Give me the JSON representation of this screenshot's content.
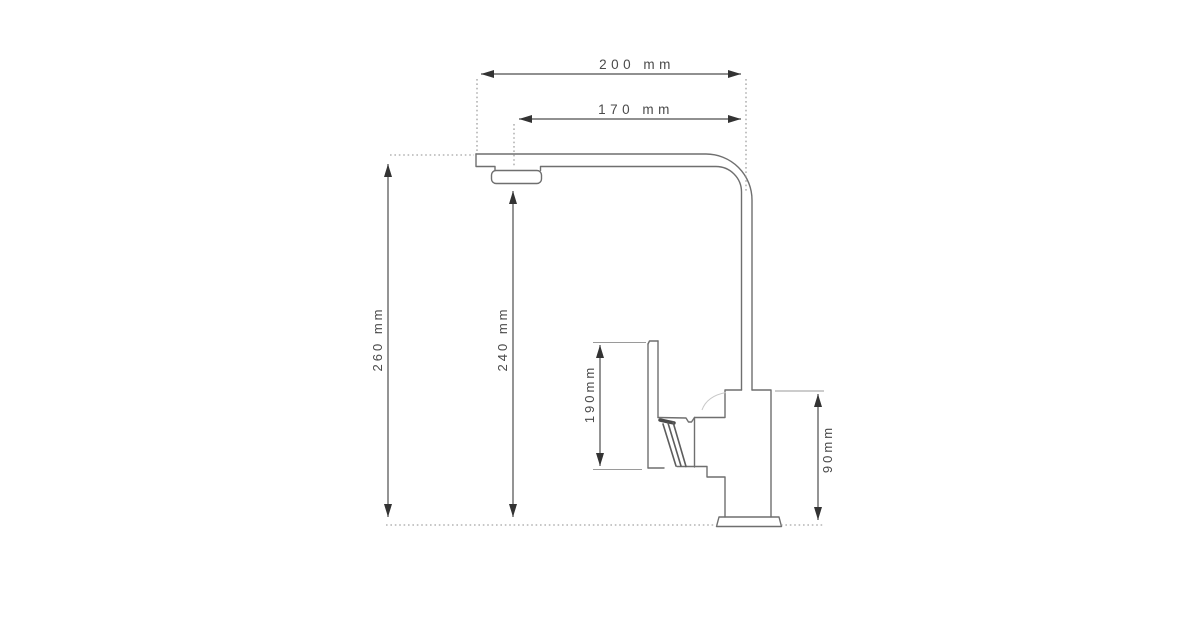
{
  "diagram": {
    "kind": "technical-drawing",
    "subject": "kitchen-faucet-side-view",
    "background_color": "#ffffff",
    "line_color": "#6f6f6f",
    "dimension_color": "#4d4d4d",
    "text_color": "#4a4a4a",
    "dimensions": {
      "spout_reach_total": {
        "label": "200 mm",
        "value_mm": 200,
        "orientation": "horizontal"
      },
      "spout_reach_aerator": {
        "label": "170 mm",
        "value_mm": 170,
        "orientation": "horizontal"
      },
      "total_height": {
        "label": "260 mm",
        "value_mm": 260,
        "orientation": "vertical"
      },
      "spout_height": {
        "label": "240 mm",
        "value_mm": 240,
        "orientation": "vertical"
      },
      "handle_height": {
        "label": "190mm",
        "value_mm": 190,
        "orientation": "vertical"
      },
      "body_height": {
        "label": "90mm",
        "value_mm": 90,
        "orientation": "vertical"
      }
    }
  }
}
